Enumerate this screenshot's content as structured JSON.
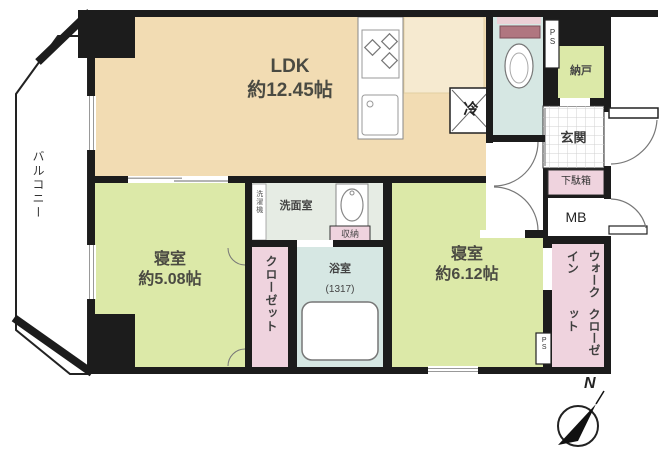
{
  "plan_title": "2LDK apartment floor plan",
  "rooms": {
    "ldk": {
      "name": "LDK",
      "size": "約12.45帖"
    },
    "bedroom_small": {
      "name": "寝室",
      "size": "約5.08帖"
    },
    "bedroom_large": {
      "name": "寝室",
      "size": "約6.12帖"
    },
    "balcony": {
      "name": "バルコニー"
    },
    "washroom": {
      "name": "洗面室"
    },
    "bathroom": {
      "name": "浴室",
      "size": "(1317)"
    },
    "closet": {
      "name": "クローゼット"
    },
    "walk_in_closet": {
      "line1": "ウォークイン",
      "line2": "クローゼット"
    },
    "nando": {
      "name": "納戸"
    },
    "genkan": {
      "name": "玄関"
    },
    "getabako": {
      "name": "下駄箱"
    },
    "meter_box": {
      "name": "MB"
    },
    "storage": {
      "name": "収納"
    },
    "refrigerator": {
      "name": "冷"
    },
    "laundry": {
      "name": "洗濯機"
    },
    "pipe_space_top": {
      "name": "PS"
    },
    "pipe_space_bottom": {
      "name": "PS"
    }
  },
  "compass": {
    "label": "N"
  },
  "palette": {
    "wall": "#1c1c1c",
    "ldk_floor": "#f2dcb3",
    "kitchen_floor": "#f6ead0",
    "bedroom_floor": "#dce9a8",
    "closet_pink": "#efd3de",
    "wet_area_blue": "#d6e7e3",
    "washroom_floor": "#e6ece4",
    "tile_line": "#d0d0d0"
  }
}
